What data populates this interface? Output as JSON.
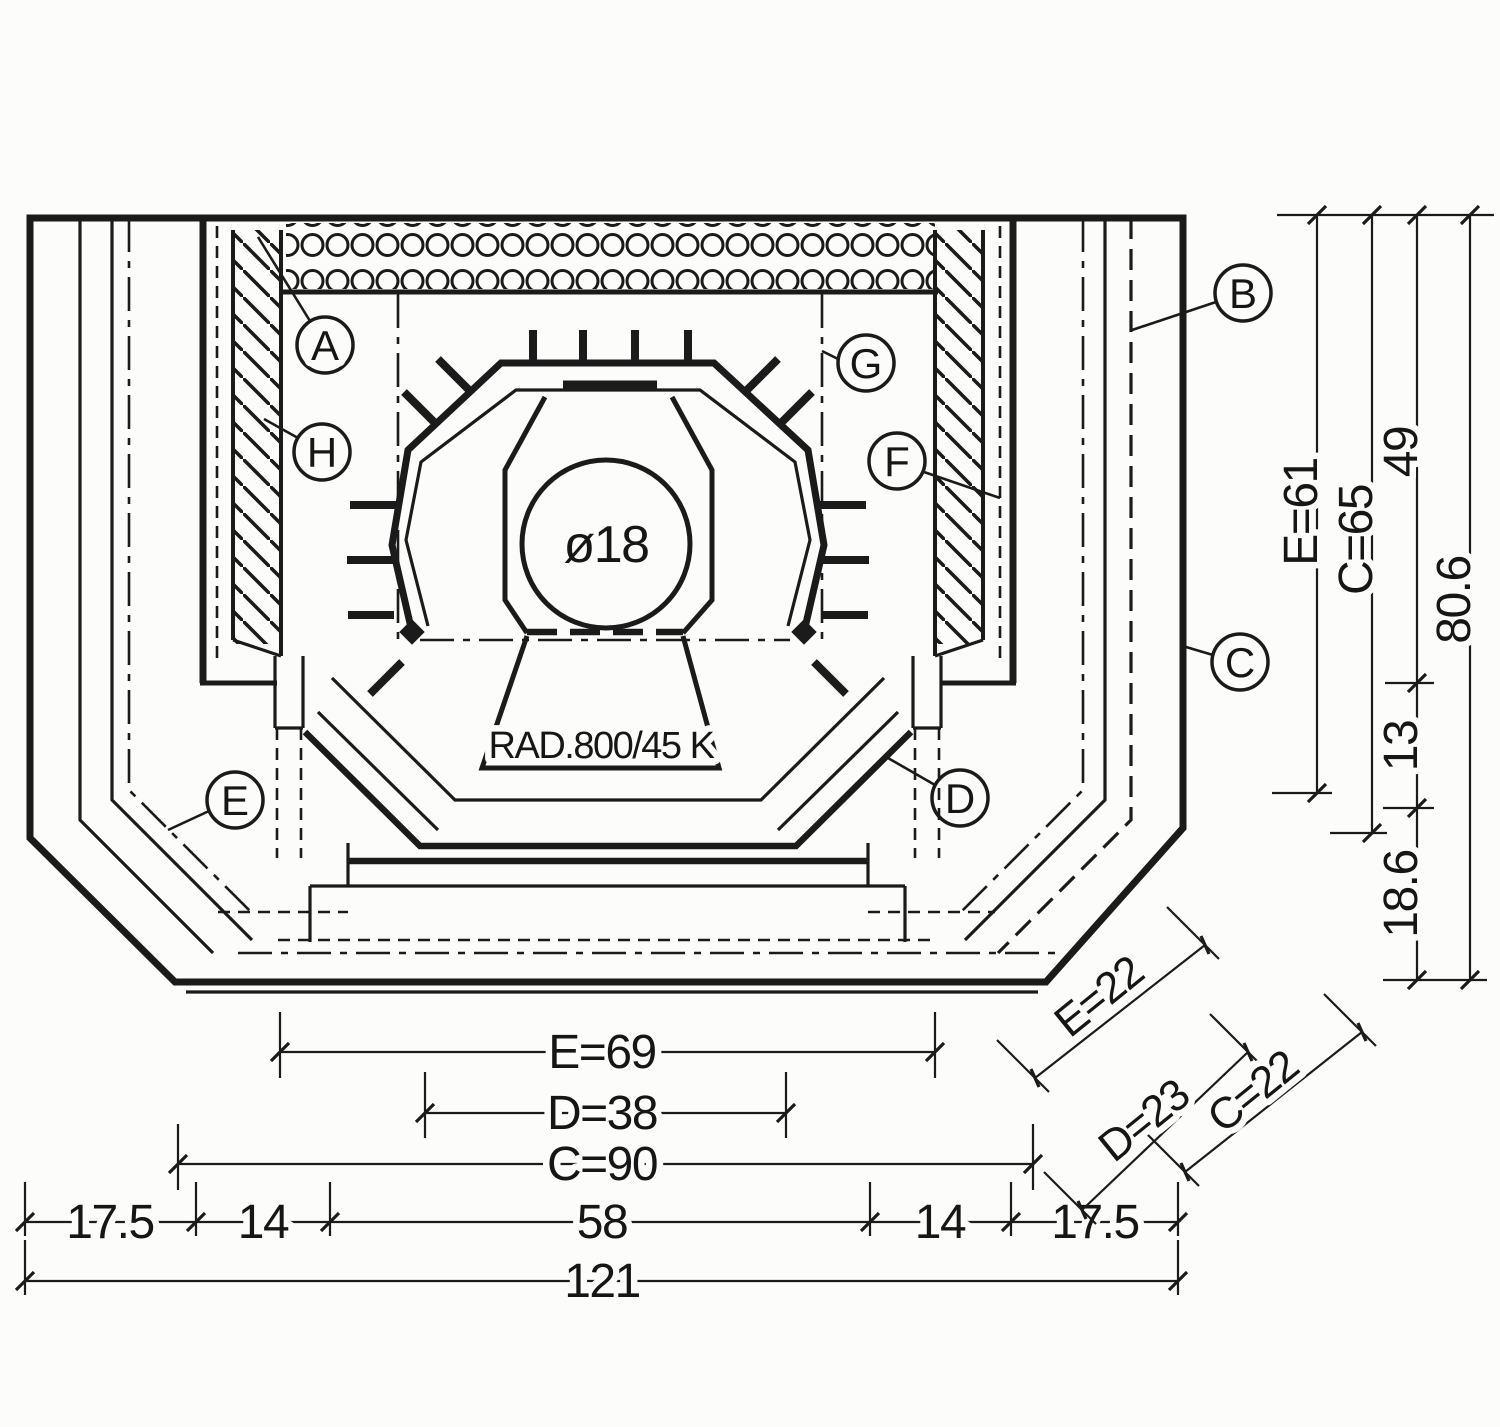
{
  "drawing": {
    "type": "stove-cross-section-technical-drawing",
    "colors": {
      "ink": "#1b1b1b",
      "paper": "#fcfcfa"
    }
  },
  "callouts": {
    "a": "A",
    "b": "B",
    "c": "C",
    "d": "D",
    "e": "E",
    "f": "F",
    "g": "G",
    "h": "H"
  },
  "annotations": {
    "flue_diameter": "ø18",
    "radiator_spec": "RAD.800/45 K"
  },
  "dimensions": {
    "bottom": {
      "e": "E=69",
      "d": "D=38",
      "c": "C=90",
      "seg1": "17.5",
      "seg2": "14",
      "seg3": "58",
      "seg4": "14",
      "seg5": "17.5",
      "total": "121"
    },
    "right": {
      "e": "E=61",
      "c": "C=65",
      "upper": "49",
      "mid": "13",
      "lower": "18.6",
      "total": "80.6"
    },
    "diagonal": {
      "e": "E=22",
      "d": "D=23",
      "c": "C=22"
    }
  }
}
